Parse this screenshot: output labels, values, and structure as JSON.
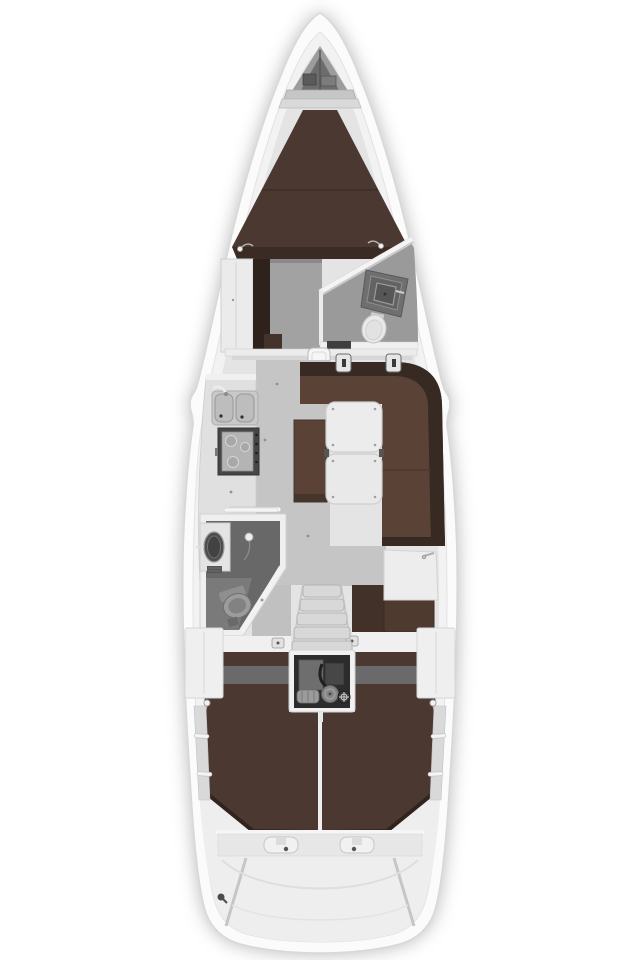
{
  "canvas": {
    "width": 640,
    "height": 960
  },
  "scene": "sailing-yacht-interior-floor-plan",
  "orientation": "bow-up",
  "areas": [
    "hull",
    "anchor-locker",
    "v-berth",
    "forward-cabin",
    "forward-head",
    "saloon",
    "galley",
    "dinette",
    "aft-head",
    "nav-station",
    "companionway",
    "engine-compartment",
    "port-aft-cabin",
    "starboard-aft-cabin",
    "transom"
  ],
  "fixtures": [
    "windlass",
    "v-berth-cushion",
    "wardrobe",
    "vanity-sink",
    "toilet",
    "mast-post",
    "double-sink",
    "faucet",
    "stove",
    "saloon-table",
    "l-settee",
    "center-bench",
    "shower-head",
    "chart-table",
    "nav-seat",
    "companionway-steps",
    "engine",
    "aft-berth-cushions",
    "stern-latches"
  ],
  "colors": {
    "hull_white": "#fbfbfb",
    "hull_stroke": "#d8d8d8",
    "deck": "#f2f2f2",
    "interior": "#e4e4e4",
    "wall": "#efefef",
    "surface": "#ececec",
    "floor": "#c5c5c5",
    "cabin_floor": "#a2a2a2",
    "head_floor": "#9a9a9a",
    "shower": "#686868",
    "locker": "#9c9c9c",
    "locker_dark": "#6d6d6d",
    "panel": "#6a6a6a",
    "uph_dark": "#4b3830",
    "uph_mid": "#5a4336",
    "uph_back": "#372a22",
    "wood": "#2e231c",
    "trim": "#30241d",
    "counter": "#e0e0e0",
    "steel": "#c7c7c7",
    "stove": "#464646",
    "stove_top": "#b4b4b4",
    "engine": "#2c2c2c",
    "metal": "#868686",
    "fixture": "#ededed",
    "toilet": "#e9e9e9",
    "band": "#e7e7e7",
    "step": "#d8d8d8"
  }
}
